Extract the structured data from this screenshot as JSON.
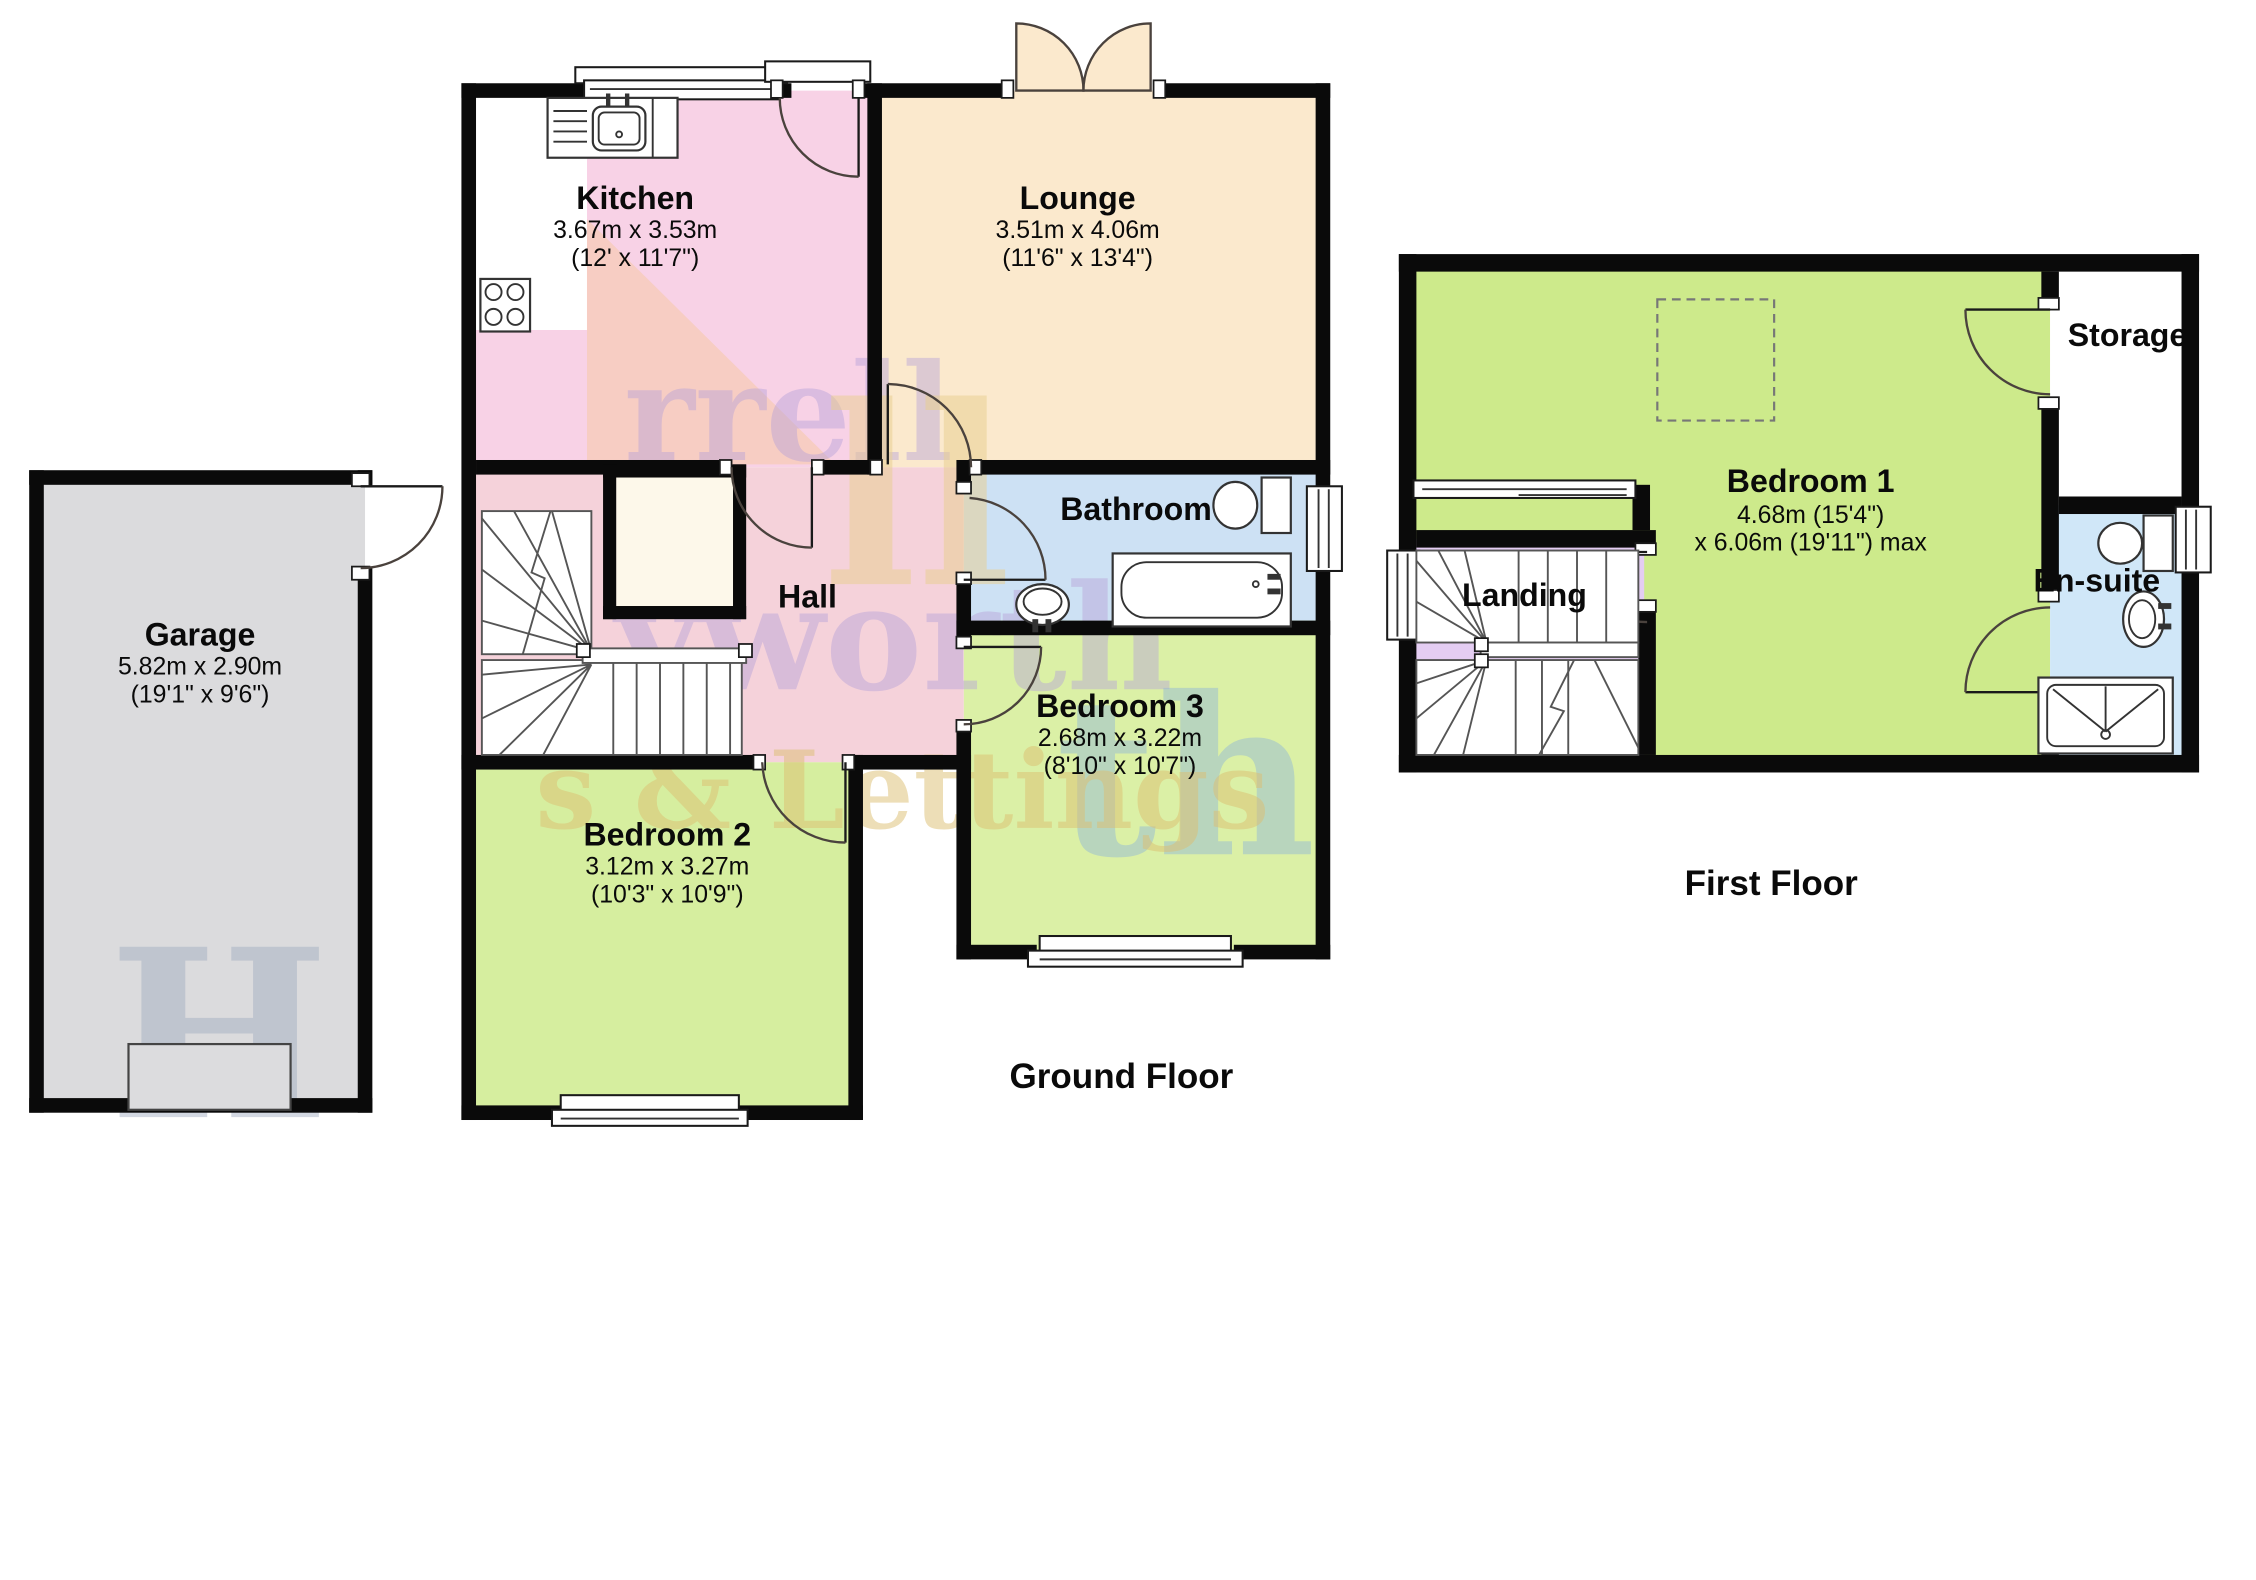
{
  "ground_floor": {
    "title": "Ground Floor",
    "kitchen": {
      "name": "Kitchen",
      "metric": "3.67m x 3.53m",
      "imperial": "(12' x 11'7\")"
    },
    "lounge": {
      "name": "Lounge",
      "metric": "3.51m x 4.06m",
      "imperial": "(11'6\" x 13'4\")"
    },
    "bathroom": {
      "name": "Bathroom"
    },
    "hall": {
      "name": "Hall"
    },
    "bedroom2": {
      "name": "Bedroom 2",
      "metric": "3.12m x 3.27m",
      "imperial": "(10'3\" x 10'9\")"
    },
    "bedroom3": {
      "name": "Bedroom 3",
      "metric": "2.68m x 3.22m",
      "imperial": "(8'10\" x 10'7\")"
    },
    "garage": {
      "name": "Garage",
      "metric": "5.82m x 2.90m",
      "imperial": "(19'1\" x 9'6\")"
    }
  },
  "first_floor": {
    "title": "First Floor",
    "bedroom1": {
      "name": "Bedroom 1",
      "metric": "4.68m (15'4\")",
      "imperial": "x 6.06m (19'11\") max"
    },
    "storage": {
      "name": "Storage"
    },
    "ensuite": {
      "name": "En-suite"
    },
    "landing": {
      "name": "Landing"
    }
  },
  "watermark": {
    "row1": "rrell",
    "gold_lounge": "ll",
    "row2": "yworth",
    "blue_bath": "th",
    "row3": "s & Lettings",
    "garage_letter": "H"
  },
  "colors": {
    "wall": "#0a0a0a",
    "kitchen": "#f8d2e6",
    "lounge": "#fbe9cd",
    "bathroom": "#cde1f4",
    "hall": "#f5d2da",
    "bedroom2": "#d6ee9f",
    "bedroom3": "#dbf0a6",
    "bedroom1": "#cdea8b",
    "landing": "#e4cdf2",
    "ensuite": "#d0e7f8",
    "garage": "#dbdbdd",
    "storage": "#ffffff",
    "watermark_purple": "#b7a3d9",
    "watermark_gold": "#dcbf72",
    "watermark_blue": "#8fb6d9"
  }
}
